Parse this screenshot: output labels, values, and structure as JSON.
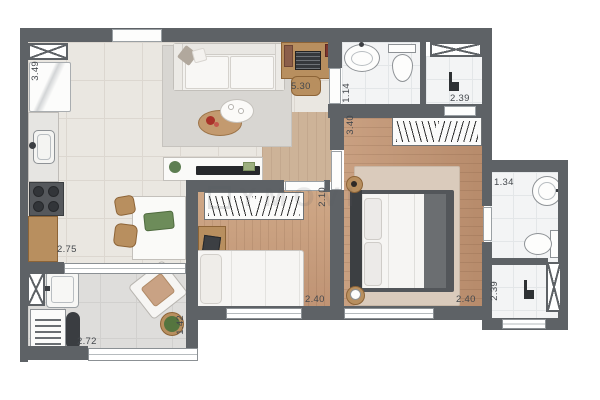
{
  "watermark": "YMOVI",
  "dims": {
    "kitchen_length": "3.49",
    "kitchen_width": "2.75",
    "living_length": "5.30",
    "bathroom_width": "1.14",
    "bathroom_shower_width": "2.39",
    "master_length": "3.40",
    "master_width": "2.40",
    "bedroom2_length": "2.10",
    "bedroom2_width": "2.40",
    "ensuite_width": "1.34",
    "ensuite_shower_length": "2.39",
    "terrace_width": "2.72",
    "terrace_depth": "1.42"
  },
  "icons": {
    "shaft": "x-cross-box",
    "shower_head": "corner-pipe",
    "wardrobe": "hanger-strokes",
    "cooktop": "four-burners"
  },
  "colors": {
    "wall": "#5e6266",
    "wood_floor": "#c09a7c",
    "tile_floor": "#eae7e1",
    "bath_tile": "#f3f4f5",
    "accent_red": "#a93229",
    "plant_green": "#5d7e52",
    "label_text": "#44484d"
  }
}
